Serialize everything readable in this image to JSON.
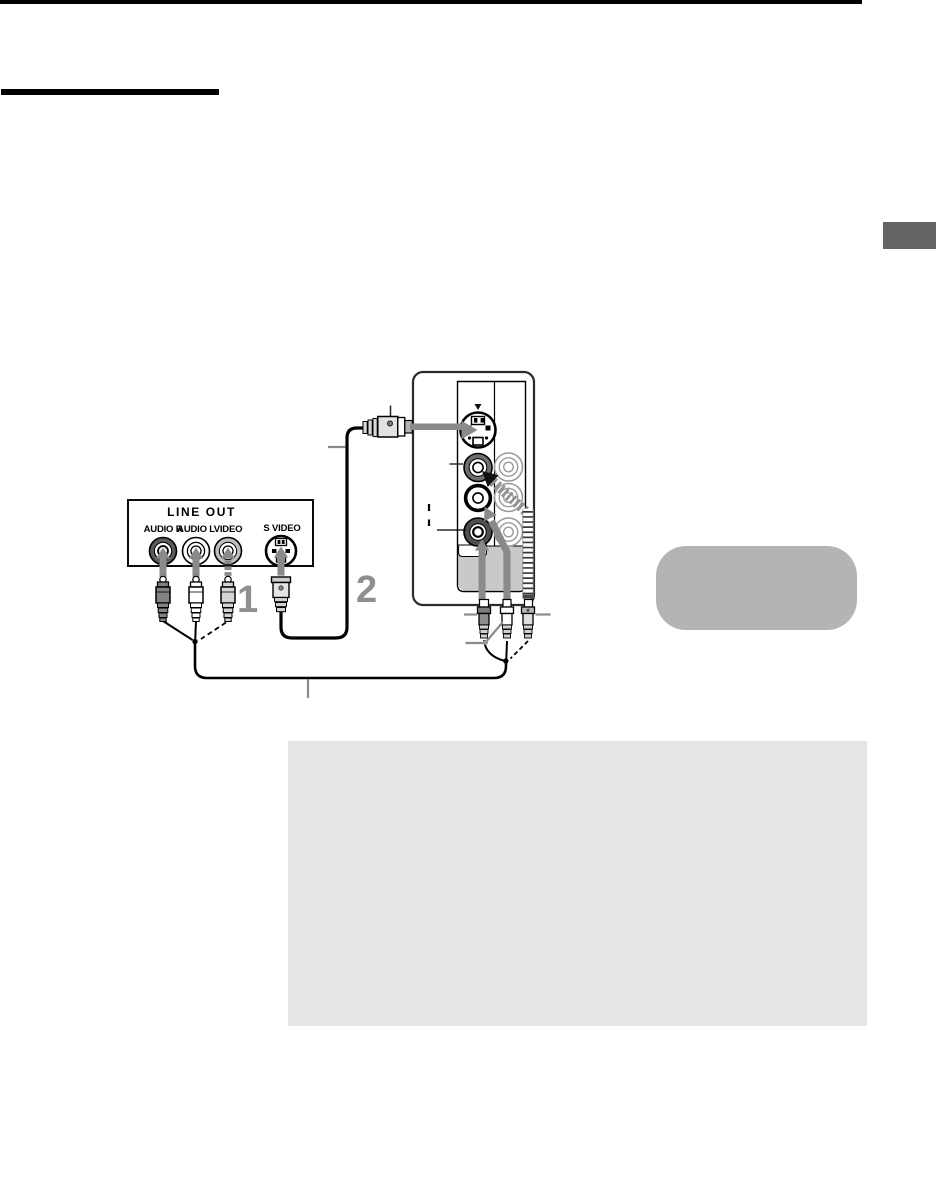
{
  "page": {
    "background": "#ffffff",
    "top_bar_color": "#000000",
    "title_rule_color": "#000000",
    "side_tab_color": "#646464"
  },
  "diagram": {
    "line_out_panel": {
      "title": "LINE OUT",
      "jacks": [
        {
          "label": "AUDIO R",
          "type": "rca-jack",
          "ring_color": "#5a5a5a"
        },
        {
          "label": "AUDIO L",
          "type": "rca-jack",
          "ring_color": "#ffffff"
        },
        {
          "label": "VIDEO",
          "type": "rca-jack",
          "ring_color": "#bdbdbd"
        },
        {
          "label": "S VIDEO",
          "type": "s-video-jack",
          "ring_color": "#ffffff"
        }
      ]
    },
    "steps": [
      "1",
      "2"
    ],
    "colors": {
      "insert_arrow": "#8a8a8a",
      "step_digit": "#8f8f8f",
      "cable": "#000000",
      "panel_recess": "#c9c9c9",
      "tip_box": "#b4b4b4",
      "note_box": "#e5e5e5"
    }
  }
}
